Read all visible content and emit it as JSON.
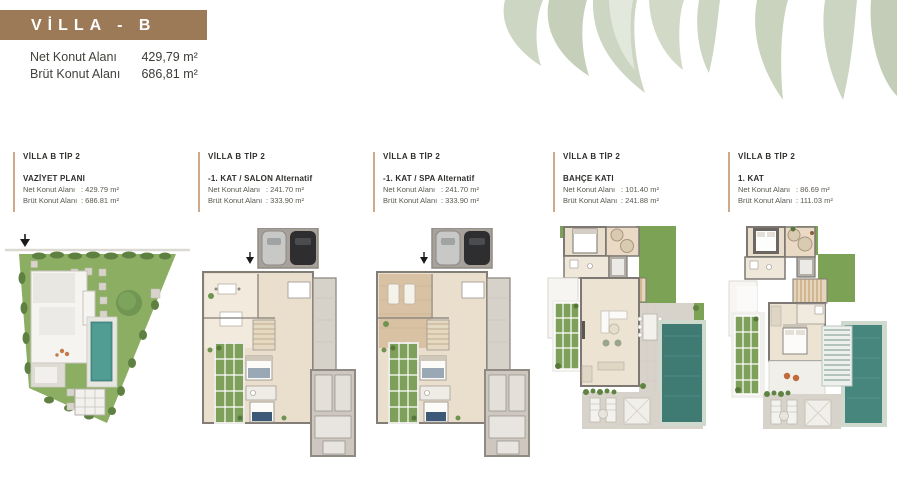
{
  "banner": {
    "title": "VİLLA - B"
  },
  "summary": {
    "net_label": "Net Konut Alanı",
    "net_value": "429,79 m²",
    "brut_label": "Brüt Konut Alanı",
    "brut_value": "686,81 m²"
  },
  "columns": [
    {
      "title": "VİLLA B TİP 2",
      "subtitle": "VAZİYET PLANI",
      "net_label": "Net Konut Alanı",
      "net_value": ": 429.79 m²",
      "brut_label": "Brüt Konut Alanı",
      "brut_value": ": 686.81 m²"
    },
    {
      "title": "VİLLA B TİP 2",
      "subtitle": "-1. KAT / SALON Alternatif",
      "net_label": "Net Konut Alanı",
      "net_value": ": 241.70 m²",
      "brut_label": "Brüt Konut Alanı",
      "brut_value": ": 333.90 m²"
    },
    {
      "title": "VİLLA B TİP 2",
      "subtitle": "-1. KAT / SPA Alternatif",
      "net_label": "Net Konut Alanı",
      "net_value": ": 241.70 m²",
      "brut_label": "Brüt Konut Alanı",
      "brut_value": ": 333.90 m²"
    },
    {
      "title": "VİLLA B TİP 2",
      "subtitle": "BAHÇE KATI",
      "net_label": "Net Konut Alanı",
      "net_value": ": 101.40 m²",
      "brut_label": "Brüt Konut Alanı",
      "brut_value": ": 241.88 m²"
    },
    {
      "title": "VİLLA B TİP 2",
      "subtitle": "1. KAT",
      "net_label": "Net Konut Alanı",
      "net_value": ": 86.69 m²",
      "brut_label": "Brüt Konut Alanı",
      "brut_value": ": 111.03 m²"
    }
  ],
  "colors": {
    "banner_brown": "#9c7a58",
    "accent_line_tan": "#cfa98c",
    "grass_green": "#8cae63",
    "pool_teal": "#4b968d",
    "leaf_sage": "#ccd6c2"
  }
}
